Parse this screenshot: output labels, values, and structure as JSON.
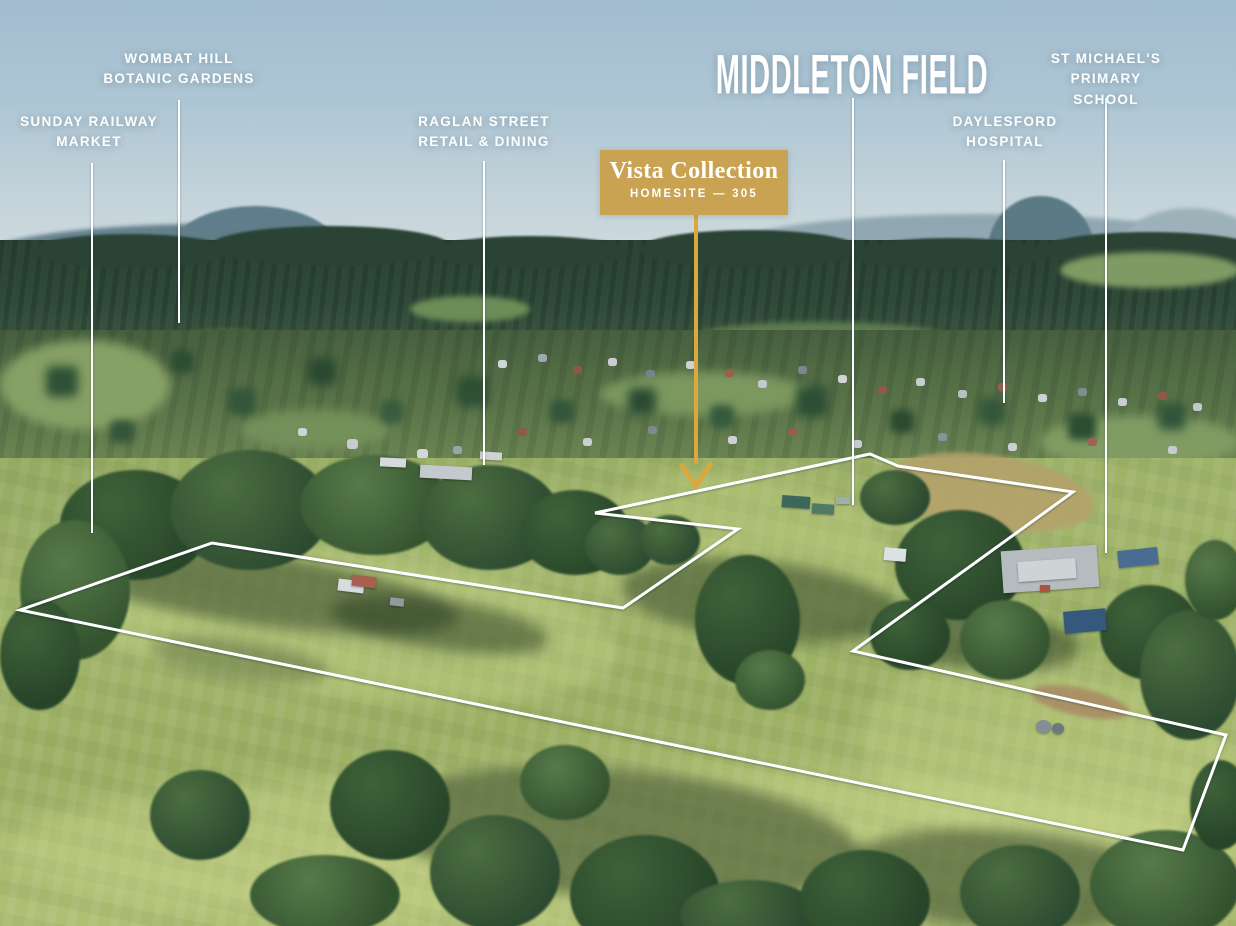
{
  "title": {
    "text": "MIDDLETON FIELD",
    "leader_points": "853,98 853,505"
  },
  "callout": {
    "title": "Vista Collection",
    "subtitle": "HOMESITE — 305",
    "arrow_shaft_points": "696,215 696,464",
    "arrow_head_points": "682,466 696,486 710,465"
  },
  "landmarks": [
    {
      "label": "SUNDAY RAILWAY\nMARKET",
      "leader_points": "92,163 92,533"
    },
    {
      "label": "WOMBAT HILL\nBOTANIC GARDENS",
      "leader_points": "179,100 179,323"
    },
    {
      "label": "RAGLAN STREET\nRETAIL & DINING",
      "leader_points": "484,161 484,465"
    },
    {
      "label": "DAYLESFORD\nHOSPITAL",
      "leader_points": "1004,160 1004,403"
    },
    {
      "label": "ST MICHAEL'S PRIMARY\nSCHOOL",
      "leader_points": "1106,98 1106,553"
    }
  ],
  "boundary": {
    "points": "20,610 212,543 623,608 738,529 595,513 870,454 898,466 1073,492 853,651 1226,735 1183,850"
  },
  "colors": {
    "accent_gold": "#C9A351",
    "arrow_gold": "#D9A83F",
    "boundary_white": "#FFFFFF",
    "label_white": "#FDFEFE"
  }
}
